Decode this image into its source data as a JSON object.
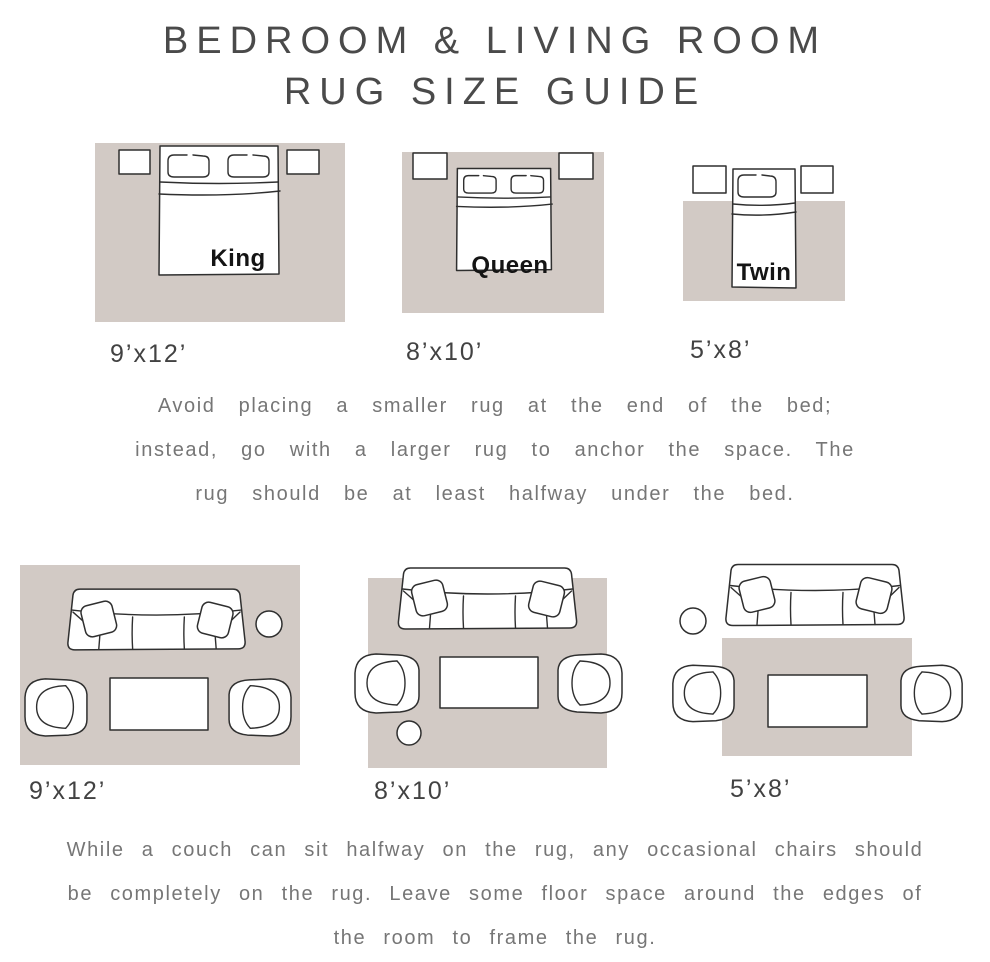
{
  "title": {
    "line1": "BEDROOM & LIVING ROOM",
    "line2": "RUG SIZE GUIDE"
  },
  "colors": {
    "rug": "#d2cac5",
    "furniture_outline": "#2f2f2f",
    "title_text": "#4a4a4a",
    "label_text": "#424242",
    "note_text": "#767676"
  },
  "bedroom_section": {
    "diagrams": [
      {
        "bed_label": "King",
        "rug_size": "9’x12’"
      },
      {
        "bed_label": "Queen",
        "rug_size": "8’x10’"
      },
      {
        "bed_label": "Twin",
        "rug_size": "5’x8’"
      }
    ],
    "note_lines": [
      "Avoid placing a smaller rug at the end of the bed;",
      "instead, go with a larger rug to anchor the space. The",
      "rug should be at least halfway under the bed."
    ]
  },
  "living_room_section": {
    "diagrams": [
      {
        "rug_size": "9’x12’"
      },
      {
        "rug_size": "8’x10’"
      },
      {
        "rug_size": "5’x8’"
      }
    ],
    "note_lines": [
      "While a couch can sit halfway on the rug, any occasional chairs should",
      "be completely on the rug. Leave some floor space around the edges of",
      "the room to frame the rug."
    ]
  }
}
